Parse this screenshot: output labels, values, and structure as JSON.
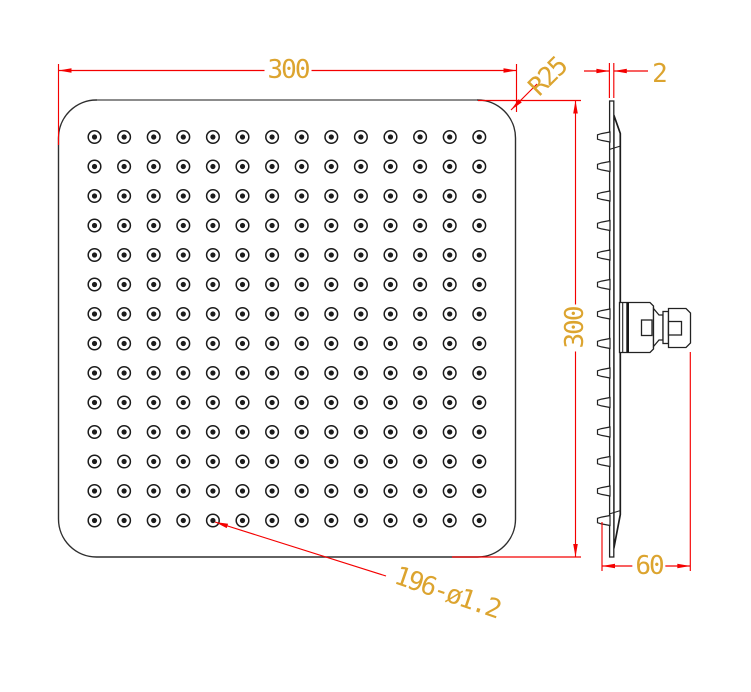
{
  "drawing": {
    "type": "technical-cad-drawing",
    "subject": "square rainfall shower head",
    "colors": {
      "dimension_lines": "#f40000",
      "dimension_text": "#DCA42F",
      "outline": "#2e2e2e",
      "background": "#ffffff"
    },
    "labels": {
      "width": "300",
      "height": "300",
      "corner_radius": "R25",
      "thickness": "2",
      "depth": "60",
      "nozzle_spec": "196-ø1.2"
    },
    "views": {
      "front": {
        "nozzle_grid": {
          "rows": 14,
          "cols": 14,
          "x0": 94.5,
          "y0": 137,
          "dx": 29.6,
          "dy": 29.5,
          "r_outer": 6.3,
          "r_inner": 2.6
        }
      },
      "side": {
        "nozzle_profile": {
          "count": 14,
          "y0": 137,
          "dy": 29.5,
          "base_x": 610,
          "tip_x": 597.5
        }
      }
    }
  }
}
